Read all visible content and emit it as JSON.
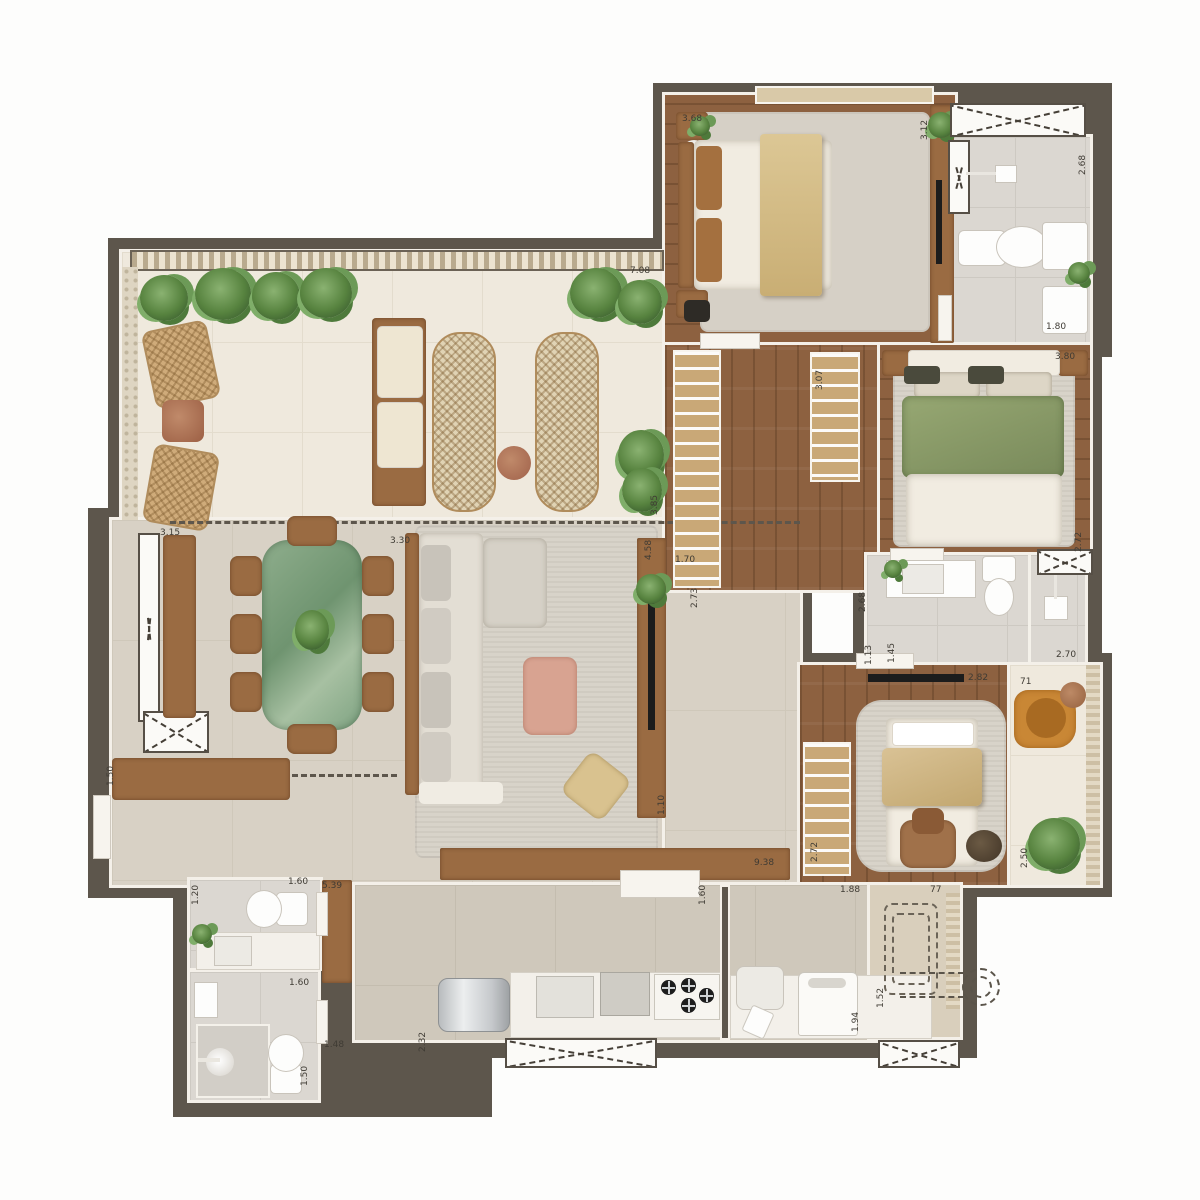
{
  "plan": {
    "type": "apartment-floor-plan",
    "colors": {
      "wall": "#5d564c",
      "terrace_floor": "#efe9dd",
      "living_floor": "#d8d1c5",
      "wood_floor": "#8d6140",
      "tile_floor": "#dbd7d1",
      "kitchen_floor": "#cfc8bb",
      "furniture_wood": "#9a6b42",
      "marble_table_green": "#7fa382",
      "bedding_green": "#8fa06b",
      "armchair_orange": "#c98735",
      "rug": "#d8d3c9"
    },
    "dimension_labels": [
      {
        "text": "7.08",
        "x": 630,
        "y": 266,
        "vertical": false
      },
      {
        "text": "3.85",
        "x": 650,
        "y": 515,
        "vertical": true
      },
      {
        "text": "3.68",
        "x": 682,
        "y": 114,
        "vertical": false
      },
      {
        "text": "3.12",
        "x": 920,
        "y": 140,
        "vertical": true
      },
      {
        "text": "2.68",
        "x": 1078,
        "y": 175,
        "vertical": true
      },
      {
        "text": "1.80",
        "x": 1046,
        "y": 322,
        "vertical": false
      },
      {
        "text": "3.80",
        "x": 1055,
        "y": 352,
        "vertical": false
      },
      {
        "text": "3.07",
        "x": 815,
        "y": 390,
        "vertical": true
      },
      {
        "text": "1.70",
        "x": 675,
        "y": 555,
        "vertical": false
      },
      {
        "text": "2.73",
        "x": 690,
        "y": 608,
        "vertical": true
      },
      {
        "text": "2.68",
        "x": 858,
        "y": 612,
        "vertical": true
      },
      {
        "text": "2.72",
        "x": 1074,
        "y": 552,
        "vertical": true
      },
      {
        "text": "1.13",
        "x": 864,
        "y": 665,
        "vertical": true
      },
      {
        "text": "1.45",
        "x": 887,
        "y": 663,
        "vertical": true
      },
      {
        "text": "2.70",
        "x": 1056,
        "y": 650,
        "vertical": false
      },
      {
        "text": "2.82",
        "x": 968,
        "y": 673,
        "vertical": false
      },
      {
        "text": "71",
        "x": 1020,
        "y": 677,
        "vertical": false
      },
      {
        "text": "2.72",
        "x": 810,
        "y": 862,
        "vertical": true
      },
      {
        "text": "2.50",
        "x": 1020,
        "y": 868,
        "vertical": true
      },
      {
        "text": "3.15",
        "x": 160,
        "y": 528,
        "vertical": false
      },
      {
        "text": "3.30",
        "x": 390,
        "y": 536,
        "vertical": false
      },
      {
        "text": "4.58",
        "x": 644,
        "y": 560,
        "vertical": true
      },
      {
        "text": "1.50",
        "x": 106,
        "y": 786,
        "vertical": true
      },
      {
        "text": "1.10",
        "x": 657,
        "y": 815,
        "vertical": true
      },
      {
        "text": "9.38",
        "x": 754,
        "y": 858,
        "vertical": false
      },
      {
        "text": "1.20",
        "x": 191,
        "y": 905,
        "vertical": true
      },
      {
        "text": "1.60",
        "x": 288,
        "y": 877,
        "vertical": false
      },
      {
        "text": "5.39",
        "x": 322,
        "y": 881,
        "vertical": false
      },
      {
        "text": "1.60",
        "x": 289,
        "y": 978,
        "vertical": false
      },
      {
        "text": "1.50",
        "x": 300,
        "y": 1086,
        "vertical": true
      },
      {
        "text": "1.48",
        "x": 324,
        "y": 1040,
        "vertical": false
      },
      {
        "text": "2.32",
        "x": 418,
        "y": 1052,
        "vertical": true
      },
      {
        "text": "1.60",
        "x": 698,
        "y": 905,
        "vertical": true
      },
      {
        "text": "1.88",
        "x": 840,
        "y": 885,
        "vertical": false
      },
      {
        "text": "77",
        "x": 930,
        "y": 885,
        "vertical": false
      },
      {
        "text": "1.52",
        "x": 876,
        "y": 1008,
        "vertical": true
      },
      {
        "text": "1.94",
        "x": 851,
        "y": 1032,
        "vertical": true
      }
    ]
  }
}
